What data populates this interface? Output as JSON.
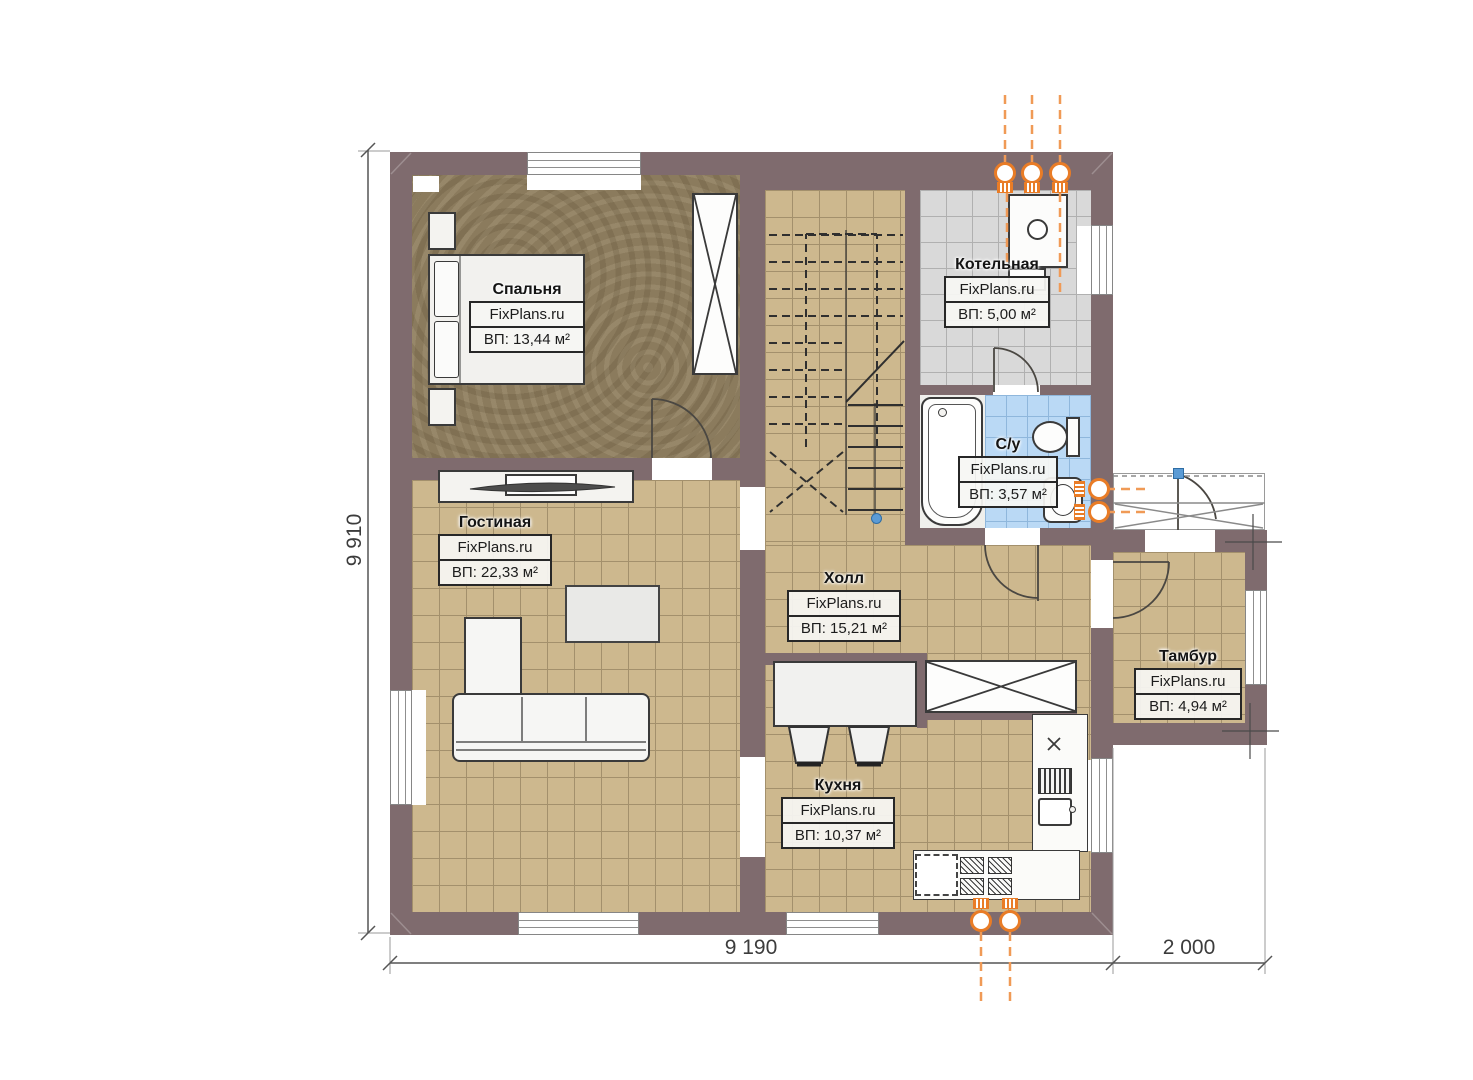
{
  "plan": {
    "watermark": "FixPlans.ru",
    "rooms": [
      {
        "name": "Спальня",
        "area": "ВП: 13,44 м²"
      },
      {
        "name": "Котельная",
        "area": "ВП: 5,00 м²"
      },
      {
        "name": "С/у",
        "area": "ВП: 3,57 м²"
      },
      {
        "name": "Гостиная",
        "area": "ВП: 22,33 м²"
      },
      {
        "name": "Холл",
        "area": "ВП: 15,21 м²"
      },
      {
        "name": "Тамбур",
        "area": "ВП: 4,94 м²"
      },
      {
        "name": "Кухня",
        "area": "ВП: 10,37 м²"
      }
    ],
    "dimensions": {
      "left_height": "9 910",
      "bottom_main_width": "9 190",
      "bottom_porch_width": "2 000"
    },
    "colors": {
      "wall": "#7f6b6e",
      "bedroom_floor": "#8b7b5d",
      "tile_beige": "#cdb88e",
      "tile_gray": "#d9d9d9",
      "tile_blue": "#bad9f5",
      "accent_orange": "#e97c26",
      "marker_blue": "#5b9bd5"
    }
  }
}
